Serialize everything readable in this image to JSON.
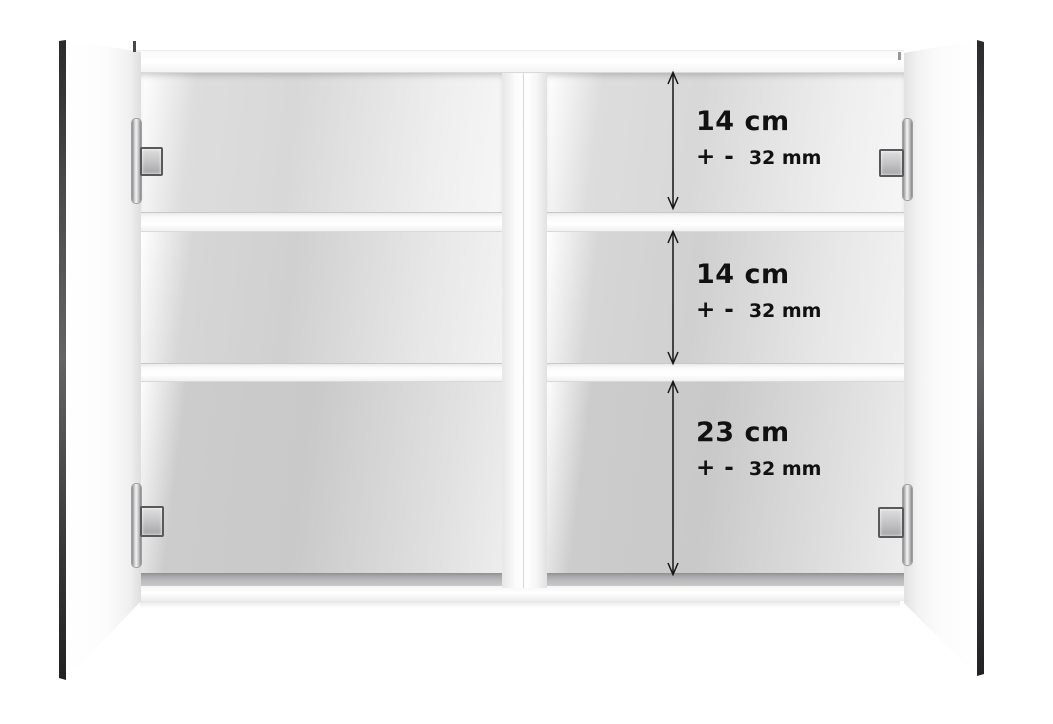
{
  "colors": {
    "background": "#ffffff",
    "door_mirror_edge": "#39393b",
    "interior_gray_dark": "#c9c9c9",
    "interior_gray_light": "#f2f2f2",
    "bottom_shadow_strip": "#b6b7b8",
    "hinge_chrome": "#d9d9db",
    "annotation_text": "#111111"
  },
  "icons": {
    "dimension_arrow": "double-headed-vertical-arrow"
  },
  "annotations": {
    "sections": [
      {
        "size": "14 cm",
        "tolerance": {
          "plus": "+",
          "minus": "-",
          "value": "32 mm"
        }
      },
      {
        "size": "14 cm",
        "tolerance": {
          "plus": "+",
          "minus": "-",
          "value": "32 mm"
        }
      },
      {
        "size": "23 cm",
        "tolerance": {
          "plus": "+",
          "minus": "-",
          "value": "32 mm"
        }
      }
    ]
  }
}
